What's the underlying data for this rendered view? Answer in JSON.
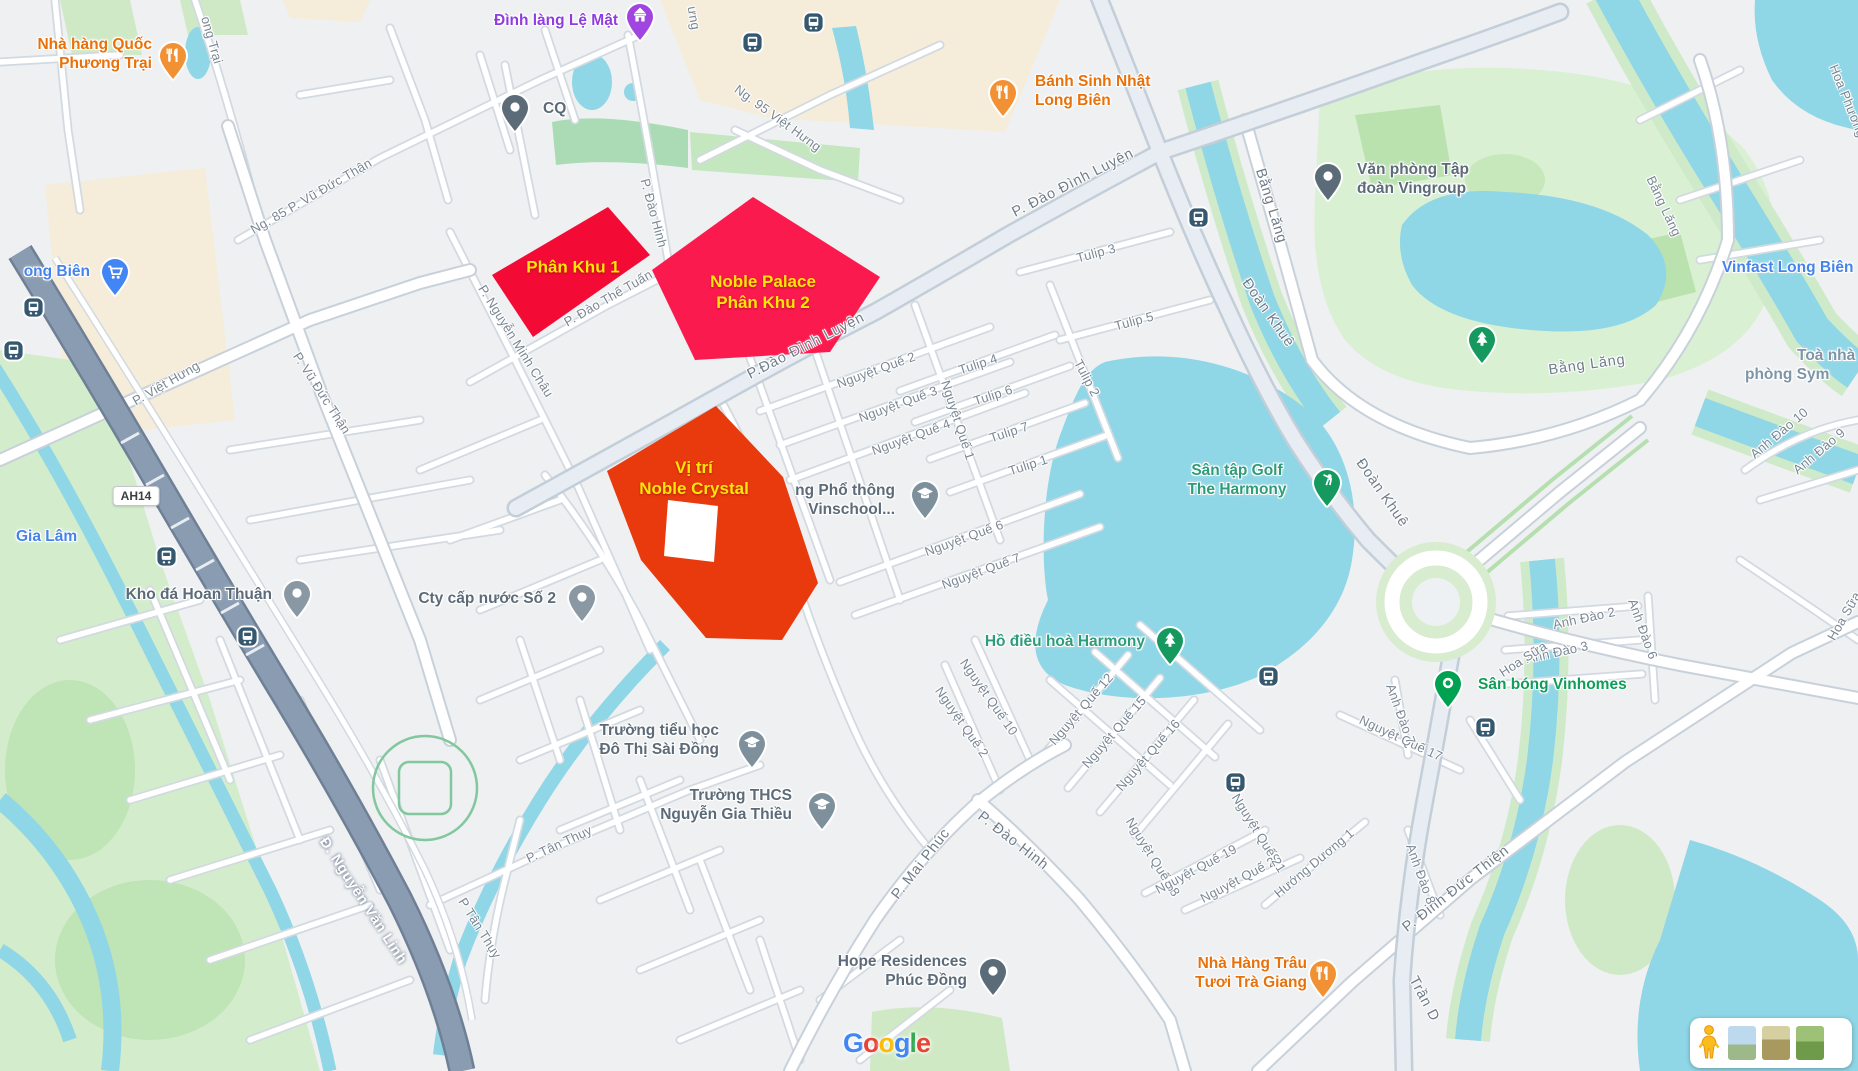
{
  "app": "google-maps-static-view",
  "attribution": {
    "logo_letters": [
      {
        "ch": "G",
        "color": "#4285F4"
      },
      {
        "ch": "o",
        "color": "#EA4335"
      },
      {
        "ch": "o",
        "color": "#FBBC05"
      },
      {
        "ch": "g",
        "color": "#4285F4"
      },
      {
        "ch": "l",
        "color": "#34A853"
      },
      {
        "ch": "e",
        "color": "#EA4335"
      }
    ]
  },
  "overlays": [
    {
      "name": "phan-khu-1",
      "lines": [
        "Phân Khu 1"
      ],
      "fill": "#f30b36",
      "text_color": "#ffe606",
      "points": "492,275 608,207 650,255 533,337",
      "cx": 573,
      "cy": 267
    },
    {
      "name": "noble-palace-phan-khu-2",
      "lines": [
        "Noble Palace",
        "Phân Khu 2"
      ],
      "fill": "#fb1a4e",
      "text_color": "#ffe606",
      "points": "753,197 880,277 830,352 695,360 652,270",
      "cx": 763,
      "cy": 292
    },
    {
      "name": "vi-tri-noble-crystal",
      "lines": [
        "Vị trí",
        "Noble Crystal"
      ],
      "fill": "#e93a0e",
      "text_color": "#ffe606",
      "points": "716,406 783,477 818,583 782,640 706,638 641,560 607,471",
      "hole": "668,500 718,506 714,562 664,556",
      "cx": 694,
      "cy": 478
    }
  ],
  "road_badges": [
    {
      "text": "AH14",
      "x": 136,
      "y": 496
    }
  ],
  "pin_colors": {
    "restaurant": "#f29133",
    "temple": "#a145e0",
    "generic": "#5b6b77",
    "generic-gray": "#8a98a3",
    "cart": "#4285f4",
    "school": "#7d909c",
    "tree": "#15995e",
    "golf": "#15995e",
    "dot-green": "#00a150",
    "bus": "#35586f",
    "pegman": "#fbbd1e"
  },
  "pins": [
    {
      "type": "restaurant",
      "name": "pin-nha-hang-quoc-phuong-trai",
      "x": 173,
      "y": 55
    },
    {
      "type": "temple",
      "name": "pin-dinh-lang-le-mat",
      "x": 640,
      "y": 16
    },
    {
      "type": "generic",
      "name": "pin-cq",
      "x": 515,
      "y": 107
    },
    {
      "type": "restaurant",
      "name": "pin-banh-sinh-nhat-long-bien",
      "x": 1003,
      "y": 92
    },
    {
      "type": "generic",
      "name": "pin-van-phong-vingroup",
      "x": 1328,
      "y": 176
    },
    {
      "type": "cart",
      "name": "pin-long-bien-market",
      "x": 115,
      "y": 271
    },
    {
      "type": "generic-gray",
      "name": "pin-kho-da-hoan-thuan",
      "x": 297,
      "y": 593
    },
    {
      "type": "generic-gray",
      "name": "pin-cty-cap-nuoc-so-2",
      "x": 582,
      "y": 597
    },
    {
      "type": "school",
      "name": "pin-vinschool",
      "x": 925,
      "y": 494
    },
    {
      "type": "school",
      "name": "pin-tieu-hoc-do-thi-sai-dong",
      "x": 752,
      "y": 743
    },
    {
      "type": "school",
      "name": "pin-thcs-nguyen-gia-thieu",
      "x": 822,
      "y": 805
    },
    {
      "type": "generic",
      "name": "pin-hope-residences",
      "x": 993,
      "y": 971
    },
    {
      "type": "restaurant",
      "name": "pin-nha-hang-trau-tuoi",
      "x": 1323,
      "y": 973
    },
    {
      "type": "tree",
      "name": "pin-ho-dieu-hoa-harmony",
      "x": 1170,
      "y": 640
    },
    {
      "type": "tree",
      "name": "pin-bang-lang-park",
      "x": 1482,
      "y": 339
    },
    {
      "type": "golf",
      "name": "pin-san-tap-golf",
      "x": 1327,
      "y": 482
    },
    {
      "type": "dot-green",
      "name": "pin-san-bong-vinhomes",
      "x": 1448,
      "y": 683
    }
  ],
  "bus_stops": [
    {
      "x": 752,
      "y": 42
    },
    {
      "x": 813,
      "y": 22
    },
    {
      "x": 33,
      "y": 307
    },
    {
      "x": 13,
      "y": 350
    },
    {
      "x": 1198,
      "y": 217
    },
    {
      "x": 1268,
      "y": 676
    },
    {
      "x": 1235,
      "y": 782
    },
    {
      "x": 1485,
      "y": 727
    },
    {
      "x": 166,
      "y": 556
    },
    {
      "x": 247,
      "y": 636
    }
  ],
  "poi_labels": [
    {
      "name": "nha-hang-quoc-phuong-trai",
      "lines": [
        "Nhà hàng Quốc",
        "Phương Trại"
      ],
      "x": 152,
      "y": 35,
      "align": "right",
      "color": "orange"
    },
    {
      "name": "dinh-lang-le-mat",
      "lines": [
        "Đình làng Lệ Mật"
      ],
      "x": 618,
      "y": 11,
      "align": "right",
      "color": "purple"
    },
    {
      "name": "cq",
      "lines": [
        "CQ"
      ],
      "x": 543,
      "y": 99,
      "align": "left",
      "color": "gray"
    },
    {
      "name": "banh-sinh-nhat-long-bien",
      "lines": [
        "Bánh Sinh Nhật",
        "Long Biên"
      ],
      "x": 1035,
      "y": 72,
      "align": "left",
      "color": "orange"
    },
    {
      "name": "van-phong-tap-doan-vingroup",
      "lines": [
        "Văn phòng Tập",
        "đoàn Vingroup"
      ],
      "x": 1357,
      "y": 160,
      "align": "left",
      "color": "gray"
    },
    {
      "name": "vinfast-long-bien",
      "lines": [
        "Vinfast Long Biên"
      ],
      "x": 1722,
      "y": 258,
      "align": "left",
      "color": "blue"
    },
    {
      "name": "toa-nha-phong-sym-1",
      "lines": [
        "Toà nhà"
      ],
      "x": 1797,
      "y": 346,
      "align": "left",
      "color": "steel"
    },
    {
      "name": "toa-nha-phong-sym-2",
      "lines": [
        "phòng Sym"
      ],
      "x": 1745,
      "y": 365,
      "align": "left",
      "color": "steel"
    },
    {
      "name": "long-bien",
      "lines": [
        "ong Biên"
      ],
      "x": 90,
      "y": 262,
      "align": "right",
      "color": "blue"
    },
    {
      "name": "gia-lam",
      "lines": [
        "Gia Lâm"
      ],
      "x": 16,
      "y": 527,
      "align": "left",
      "color": "blue"
    },
    {
      "name": "kho-da-hoan-thuan",
      "lines": [
        "Kho đá Hoan Thuận"
      ],
      "x": 272,
      "y": 585,
      "align": "right",
      "color": "gray"
    },
    {
      "name": "cty-cap-nuoc-so-2",
      "lines": [
        "Cty cấp nước Số 2"
      ],
      "x": 556,
      "y": 589,
      "align": "right",
      "color": "gray"
    },
    {
      "name": "truong-vinschool",
      "lines": [
        "ng Phổ thông",
        "Vinschool..."
      ],
      "x": 895,
      "y": 481,
      "align": "right",
      "color": "gray"
    },
    {
      "name": "san-tap-golf-the-harmony",
      "lines": [
        "Sân tập Golf",
        "The Harmony"
      ],
      "x": 1237,
      "y": 461,
      "align": "center",
      "color": "green-lake"
    },
    {
      "name": "ho-dieu-hoa-harmony",
      "lines": [
        "Hồ điều hoà Harmony"
      ],
      "x": 1145,
      "y": 632,
      "align": "right",
      "color": "green-lake"
    },
    {
      "name": "san-bong-vinhomes",
      "lines": [
        "Sân bóng Vinhomes"
      ],
      "x": 1478,
      "y": 675,
      "align": "left",
      "color": "green"
    },
    {
      "name": "truong-tieu-hoc-do-thi-sai-dong",
      "lines": [
        "Trường tiểu học",
        "Đô Thị Sài Đồng"
      ],
      "x": 719,
      "y": 721,
      "align": "right",
      "color": "gray"
    },
    {
      "name": "truong-thcs-nguyen-gia-thieu",
      "lines": [
        "Trường THCS",
        "Nguyễn Gia Thiều"
      ],
      "x": 792,
      "y": 786,
      "align": "right",
      "color": "gray"
    },
    {
      "name": "hope-residences-phuc-dong",
      "lines": [
        "Hope Residences",
        "Phúc Đồng"
      ],
      "x": 967,
      "y": 952,
      "align": "right",
      "color": "gray"
    },
    {
      "name": "nha-hang-trau-tuoi-tra-giang",
      "lines": [
        "Nhà Hàng Trâu",
        "Tươi Trà Giang"
      ],
      "x": 1307,
      "y": 954,
      "align": "right",
      "color": "orange"
    }
  ],
  "poi_colors": {
    "orange": "#e8710a",
    "purple": "#8f3ce0",
    "blue": "#4683ea",
    "gray": "#5d6b78",
    "steel": "#7e95a8",
    "green": "#0f9d58",
    "green-lake": "#2e9c78"
  },
  "street_labels": [
    {
      "text": "ong Trại",
      "x": 212,
      "y": 40,
      "rot": 74
    },
    {
      "text": "ưng",
      "x": 694,
      "y": 18,
      "rot": 80
    },
    {
      "text": "Ng. 95 Việt Hưng",
      "x": 778,
      "y": 118,
      "rot": 36
    },
    {
      "text": "P. Đào Đình Luyện",
      "x": 1073,
      "y": 183,
      "rot": -27,
      "v": "street-big"
    },
    {
      "text": "P.Đào Đình Luyện",
      "x": 806,
      "y": 346,
      "rot": -27,
      "v": "street-big"
    },
    {
      "text": "P. Việt Hưng",
      "x": 166,
      "y": 383,
      "rot": -30
    },
    {
      "text": "Ng. 85 P. Vũ Đức Thận",
      "x": 311,
      "y": 196,
      "rot": -30
    },
    {
      "text": "P. Vũ Đức Thận",
      "x": 322,
      "y": 393,
      "rot": 57
    },
    {
      "text": "P. Nguyễn Minh Châu",
      "x": 516,
      "y": 341,
      "rot": 58
    },
    {
      "text": "P. Đào Hinh",
      "x": 654,
      "y": 213,
      "rot": 75
    },
    {
      "text": "P. Đào Thế Tuấn",
      "x": 608,
      "y": 298,
      "rot": -30
    },
    {
      "text": "Bằng Lăng",
      "x": 1271,
      "y": 206,
      "rot": 73,
      "v": "street-big"
    },
    {
      "text": "Đoàn Khuê",
      "x": 1268,
      "y": 313,
      "rot": 55,
      "v": "street-big"
    },
    {
      "text": "Đoàn Khuê",
      "x": 1382,
      "y": 493,
      "rot": 55,
      "v": "street-big"
    },
    {
      "text": "Bằng Lăng",
      "x": 1587,
      "y": 365,
      "rot": -8,
      "v": "street-big"
    },
    {
      "text": "Bằng Lăng",
      "x": 1664,
      "y": 206,
      "rot": 65
    },
    {
      "text": "Tulip 3",
      "x": 1096,
      "y": 253,
      "rot": -15
    },
    {
      "text": "Tulip 5",
      "x": 1134,
      "y": 321,
      "rot": -15
    },
    {
      "text": "Tulip 4",
      "x": 978,
      "y": 364,
      "rot": -18
    },
    {
      "text": "Tulip 6",
      "x": 993,
      "y": 395,
      "rot": -18
    },
    {
      "text": "Tulip 7",
      "x": 1009,
      "y": 432,
      "rot": -18
    },
    {
      "text": "Tulip 1",
      "x": 1028,
      "y": 465,
      "rot": -18
    },
    {
      "text": "Tulip 2",
      "x": 1087,
      "y": 378,
      "rot": 62
    },
    {
      "text": "Nguyệt Quế 2",
      "x": 876,
      "y": 370,
      "rot": -20
    },
    {
      "text": "Nguyệt Quế 3",
      "x": 898,
      "y": 404,
      "rot": -20
    },
    {
      "text": "Nguyệt Quế 4",
      "x": 911,
      "y": 437,
      "rot": -20
    },
    {
      "text": "Nguyệt Quế 1",
      "x": 958,
      "y": 420,
      "rot": 72
    },
    {
      "text": "Nguyệt Quế 6",
      "x": 964,
      "y": 538,
      "rot": -20
    },
    {
      "text": "Nguyệt Quế 7",
      "x": 981,
      "y": 571,
      "rot": -20
    },
    {
      "text": "Nguyệt Quế 10",
      "x": 989,
      "y": 697,
      "rot": 55
    },
    {
      "text": "Nguyệt Quế 2",
      "x": 962,
      "y": 722,
      "rot": 55
    },
    {
      "text": "Nguyệt Quế 12",
      "x": 1081,
      "y": 709,
      "rot": -49
    },
    {
      "text": "Nguyệt Quế 15",
      "x": 1114,
      "y": 732,
      "rot": -49
    },
    {
      "text": "Nguyệt Quế 16",
      "x": 1148,
      "y": 755,
      "rot": -49
    },
    {
      "text": "Nguyệt Quế 17",
      "x": 1401,
      "y": 738,
      "rot": 25
    },
    {
      "text": "Nguyệt Quế 18",
      "x": 1153,
      "y": 857,
      "rot": 58
    },
    {
      "text": "Nguyệt Quế 19",
      "x": 1196,
      "y": 869,
      "rot": -28
    },
    {
      "text": "Nguyệt Quế 20",
      "x": 1241,
      "y": 878,
      "rot": -28
    },
    {
      "text": "Nguyệt Quế 21",
      "x": 1259,
      "y": 833,
      "rot": 58
    },
    {
      "text": "Hướng Dương 1",
      "x": 1314,
      "y": 863,
      "rot": -40
    },
    {
      "text": "P. Mai Phúc",
      "x": 921,
      "y": 864,
      "rot": -52,
      "v": "street-big"
    },
    {
      "text": "P. Đào Hinh",
      "x": 1013,
      "y": 841,
      "rot": 38,
      "v": "street-big"
    },
    {
      "text": "P. Tân Thụy",
      "x": 559,
      "y": 844,
      "rot": -25
    },
    {
      "text": "P Tân Thụy",
      "x": 480,
      "y": 928,
      "rot": 58
    },
    {
      "text": "P. Đinh Đức Thiện",
      "x": 1456,
      "y": 889,
      "rot": -38,
      "v": "street-big"
    },
    {
      "text": "Trần D",
      "x": 1424,
      "y": 999,
      "rot": 62,
      "v": "street-big"
    },
    {
      "text": "Anh Đào 2",
      "x": 1584,
      "y": 618,
      "rot": -12
    },
    {
      "text": "Anh Đào 3",
      "x": 1557,
      "y": 652,
      "rot": -12
    },
    {
      "text": "Anh Đào 6",
      "x": 1643,
      "y": 629,
      "rot": 70
    },
    {
      "text": "Anh Đào 7",
      "x": 1401,
      "y": 714,
      "rot": 70
    },
    {
      "text": "Anh Đào 8",
      "x": 1421,
      "y": 874,
      "rot": 70
    },
    {
      "text": "Anh Đào 9",
      "x": 1819,
      "y": 451,
      "rot": -40
    },
    {
      "text": "Anh Đào 10",
      "x": 1779,
      "y": 433,
      "rot": -40
    },
    {
      "text": "Hoa Sữa",
      "x": 1523,
      "y": 659,
      "rot": -33
    },
    {
      "text": "Hoa Sữa",
      "x": 1844,
      "y": 616,
      "rot": -60
    },
    {
      "text": "Hoa Phương 3",
      "x": 1850,
      "y": 106,
      "rot": 68
    },
    {
      "text": "Đ. Nguyễn Văn Linh",
      "x": 363,
      "y": 901,
      "rot": 57,
      "v": "street-hwy"
    }
  ],
  "controls": {
    "pegman": "pegman-icon",
    "thumbnails": [
      "imagery-water",
      "imagery-terrain",
      "imagery-greenery"
    ]
  }
}
